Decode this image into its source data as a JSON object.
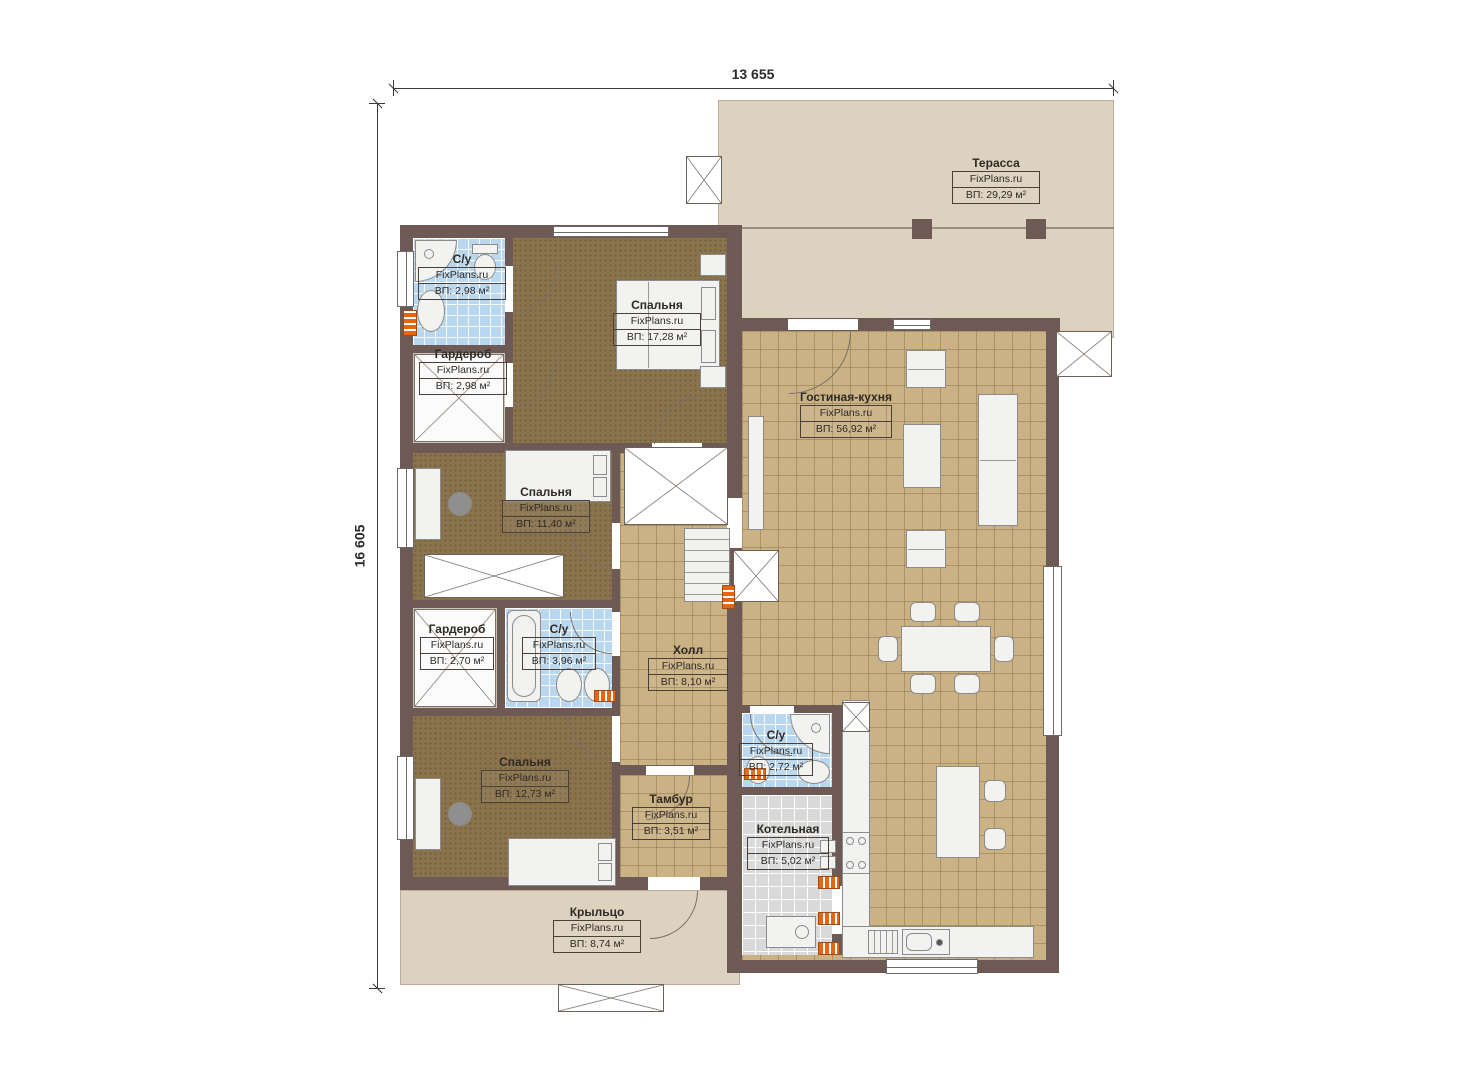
{
  "plan": {
    "title": "FixPlans floor plan",
    "brand": "FixPlans.ru",
    "dimensions": {
      "top": "13 655",
      "left": "16 605"
    },
    "rooms": [
      {
        "id": "terrace",
        "name": "Терасса",
        "area": "ВП: 29,29 м²"
      },
      {
        "id": "wc_top",
        "name": "С/у",
        "area": "ВП: 2,98 м²"
      },
      {
        "id": "bedroom_top",
        "name": "Спальня",
        "area": "ВП: 17,28 м²"
      },
      {
        "id": "wardrobe_top",
        "name": "Гардероб",
        "area": "ВП: 2,98 м²"
      },
      {
        "id": "living_kitchen",
        "name": "Гостиная-кухня",
        "area": "ВП: 56,92 м²"
      },
      {
        "id": "bedroom_mid",
        "name": "Спальня",
        "area": "ВП: 11,40 м²"
      },
      {
        "id": "wardrobe_mid",
        "name": "Гардероб",
        "area": "ВП: 2,70 м²"
      },
      {
        "id": "wc_mid",
        "name": "С/у",
        "area": "ВП: 3,96 м²"
      },
      {
        "id": "hall",
        "name": "Холл",
        "area": "ВП: 8,10 м²"
      },
      {
        "id": "wc_right",
        "name": "С/у",
        "area": "ВП: 2,72 м²"
      },
      {
        "id": "bedroom_bottom",
        "name": "Спальня",
        "area": "ВП: 12,73 м²"
      },
      {
        "id": "tambur",
        "name": "Тамбур",
        "area": "ВП: 3,51 м²"
      },
      {
        "id": "boiler",
        "name": "Котельная",
        "area": "ВП: 5,02 м²"
      },
      {
        "id": "porch",
        "name": "Крыльцо",
        "area": "ВП: 8,74 м²"
      }
    ],
    "colors": {
      "wall": "#6d5a55",
      "tile_tan": "#cbb285",
      "carpet": "#8b744d",
      "tile_bath": "#b9d7ee",
      "tile_boiler": "#d9d9d9",
      "terrace": "#ddd2bf",
      "radiator": "#e8650f"
    }
  }
}
